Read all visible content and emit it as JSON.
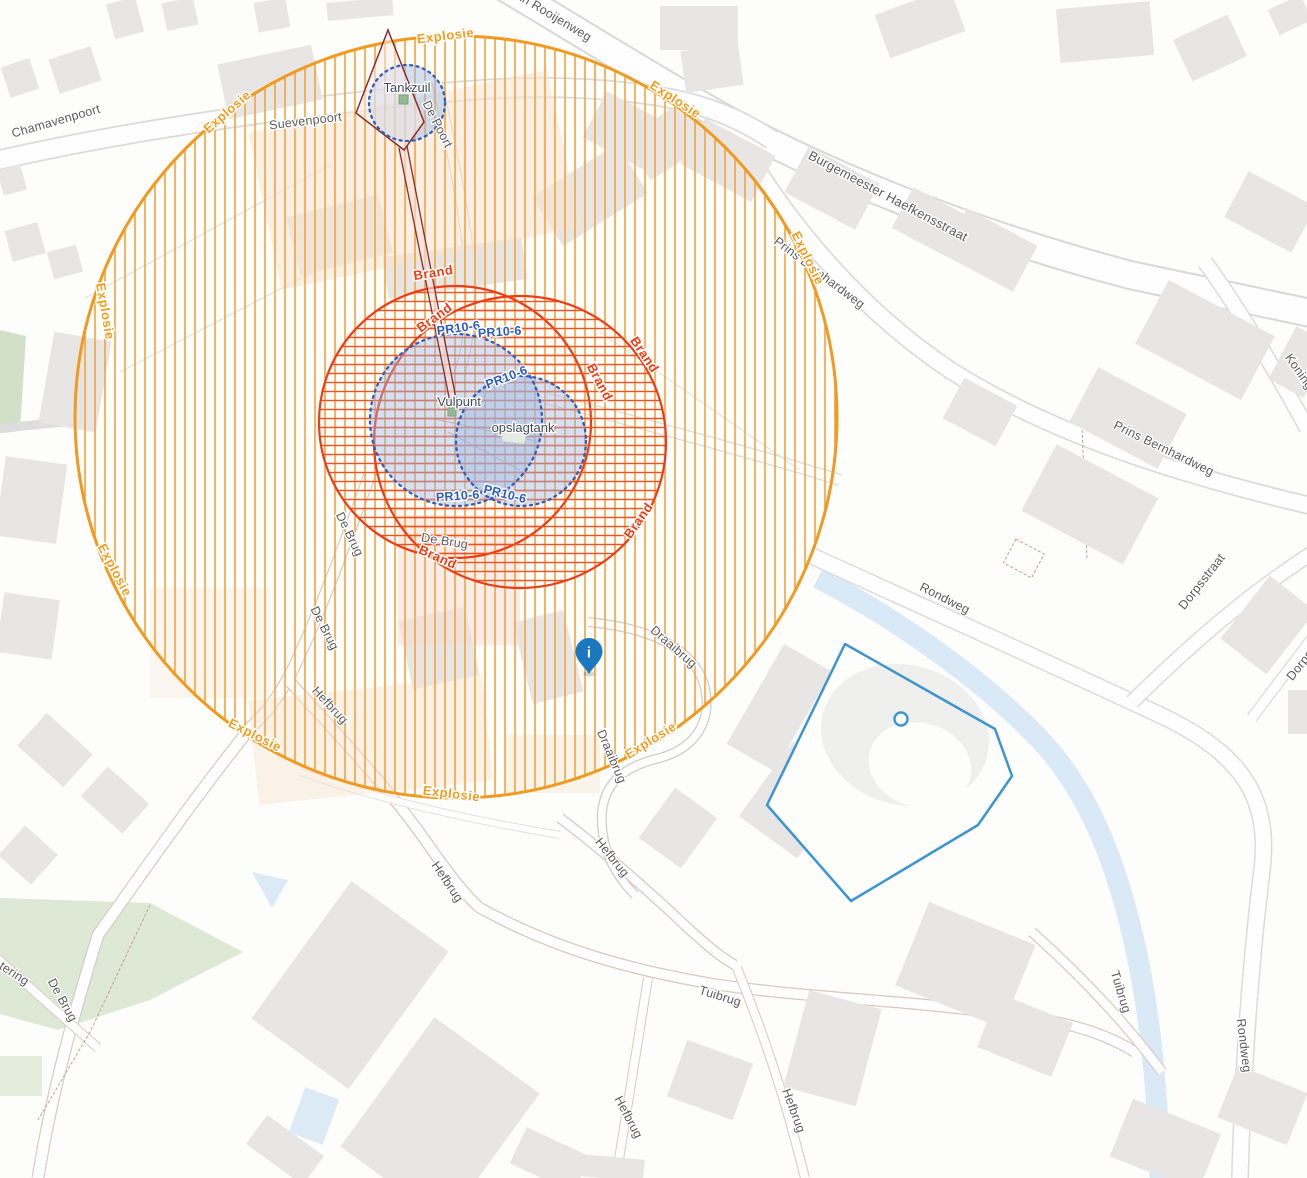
{
  "map": {
    "streets": {
      "chamavenpoort": "Chamavenpoort",
      "suevenpoort": "Suevenpoort",
      "van_rooijenweg": "van Rooijenweg",
      "burgemeester_haefkensstraat": "Burgemeester Haefkensstraat",
      "prins_bernhardweg": "Prins Bernhardweg",
      "koningin": "Koningin",
      "dorpsstraat": "Dorpsstraat",
      "rondweg": "Rondweg",
      "draaibrug": "Draaibrug",
      "hefbrug": "Hefbrug",
      "tuibrug": "Tuibrug",
      "de_brug": "De Brug",
      "de_poort": "De Poort",
      "tering": "tering"
    },
    "sites": {
      "tankzuil": "Tankzuil",
      "vulpunt": "Vulpunt",
      "opslagtank": "opslagtank"
    },
    "zones": {
      "explosie": "Explosie",
      "brand": "Brand",
      "pr10_6": "PR10-6"
    },
    "marker": {
      "glyph": "i"
    },
    "colors": {
      "explosie_zone": "#F29A1F",
      "brand_zone": "#EF3C14",
      "pr_contour": "#2C5FC0",
      "pr_fill": "#9DB8E4",
      "pipe": "#8C2B2B",
      "selection_polygon": "#3D95CF",
      "pin": "#1B78BE",
      "water": "#D9E9F6",
      "building": "#E7E6E5",
      "park": "#DDE8D5"
    }
  }
}
